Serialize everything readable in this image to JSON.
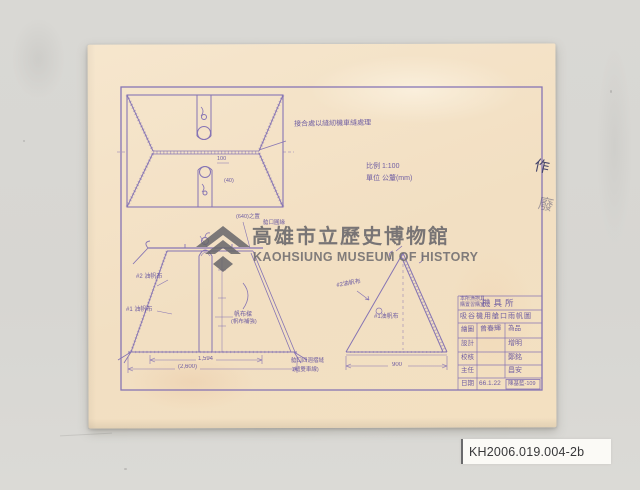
{
  "watermark": {
    "cn": "高雄市立歷史博物館",
    "en": "KAOHSIUNG MUSEUM OF HISTORY"
  },
  "catalog": {
    "number": "KH2006.019.004-2b"
  },
  "annotations": {
    "seam_note": "接合處以縫紉機車縫處理",
    "scale": "比例 1:100",
    "unit": "單位 公釐(mm)",
    "void_char_1": "作",
    "void_char_2": "廢"
  },
  "plan": {
    "dim_a": "100",
    "dim_b": "(40)"
  },
  "elevation": {
    "label_canvas2": "#2 油帆布",
    "label_canvas1": "#1 油帆布",
    "label_beam_1": "帆布樑",
    "label_beam_2": "(帆布補強)",
    "note_top_1": "(640)之置",
    "note_top_2": "艙口圓緣",
    "dim_inner": "1,594",
    "dim_outer": "(2,600)",
    "note_corner_1": "艙口四週摺縫",
    "note_corner_2": "(縫雙車線)"
  },
  "side": {
    "label_canvas2": "#2油帆布",
    "label_canvas1": "#1油帆布",
    "dim_base": "900"
  },
  "title_block": {
    "unit_line1": "本所漁撈具",
    "unit_line2": "購置習購室",
    "unit_name": "機具所",
    "drawing_title": "吸谷機用艙口雨帆圖",
    "rows": [
      {
        "label": "繪圖",
        "value": "曾春輝",
        "value2": "為品"
      },
      {
        "label": "設計",
        "value": "",
        "value2": "增明"
      },
      {
        "label": "校核",
        "value": "",
        "value2": "鄭銘"
      },
      {
        "label": "主任",
        "value": "",
        "value2": "昌安"
      }
    ],
    "date_label": "日期",
    "date_value": "66.1.22",
    "stamp": "陳基藍-109"
  }
}
